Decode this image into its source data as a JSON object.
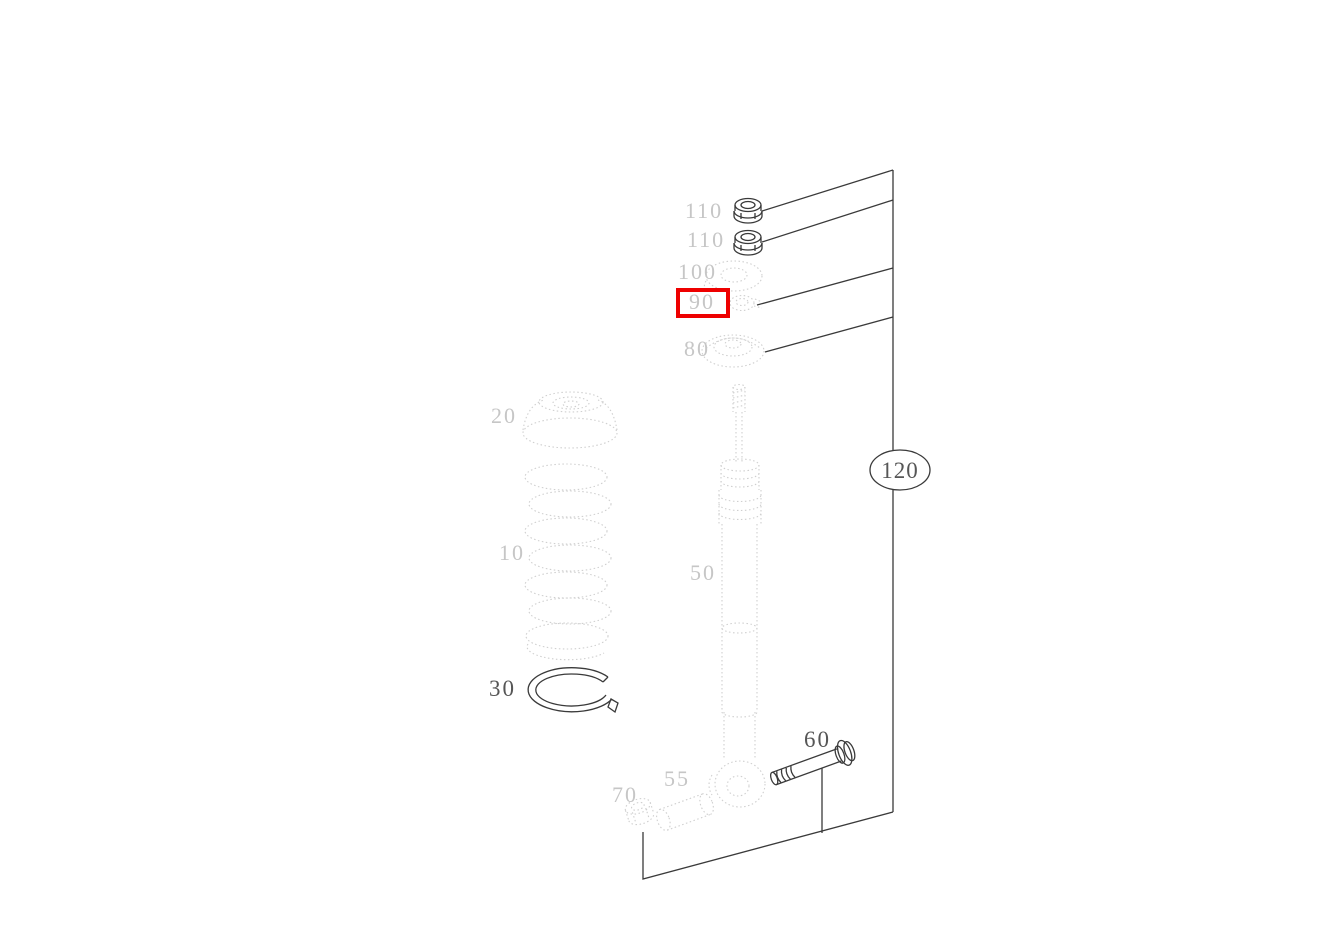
{
  "diagram": {
    "highlight_color": "#ee0000",
    "highlighted_part": "90",
    "assembly_callout": "120",
    "labels": {
      "p110a": "110",
      "p110b": "110",
      "p100": "100",
      "p90": "90",
      "p80": "80",
      "p20": "20",
      "p10": "10",
      "p30": "30",
      "p50": "50",
      "p55": "55",
      "p70": "70",
      "p60": "60",
      "p120": "120"
    }
  }
}
